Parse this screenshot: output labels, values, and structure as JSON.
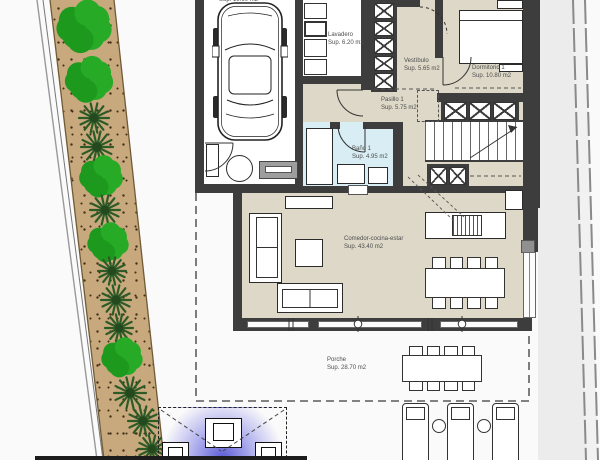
{
  "floorplan": {
    "garage": {
      "area": "Sup. 19.60 m2"
    },
    "lavadero": {
      "name": "Lavadero",
      "area": "Sup. 6.20 m2"
    },
    "vestibulo": {
      "name": "Vestíbulo",
      "area": "Sup. 5.65 m2"
    },
    "dormitorio1": {
      "name": "Dormitorio 1",
      "area": "Sup. 10.80 m2"
    },
    "pasillo1": {
      "name": "Pasillo 1",
      "area": "Sup. 5.75 m2"
    },
    "bano1": {
      "name": "Baño 1",
      "area": "Sup. 4.95 m2"
    },
    "comedor": {
      "name": "Comedor-cocina-estar",
      "area": "Sup. 43.40 m2"
    },
    "porche": {
      "name": "Porche",
      "area": "Sup. 28.70 m2"
    }
  },
  "garden": {
    "trees": [
      {
        "type": "tree",
        "x": 84,
        "y": 26,
        "r": 24
      },
      {
        "type": "tree",
        "x": 89,
        "y": 79,
        "r": 21
      },
      {
        "type": "palm",
        "x": 94,
        "y": 118,
        "r": 15
      },
      {
        "type": "palm",
        "x": 97,
        "y": 147,
        "r": 16
      },
      {
        "type": "tree",
        "x": 101,
        "y": 176,
        "r": 19
      },
      {
        "type": "palm",
        "x": 105,
        "y": 210,
        "r": 15
      },
      {
        "type": "tree",
        "x": 108,
        "y": 242,
        "r": 18
      },
      {
        "type": "palm",
        "x": 112,
        "y": 271,
        "r": 14
      },
      {
        "type": "palm",
        "x": 116,
        "y": 300,
        "r": 15
      },
      {
        "type": "palm",
        "x": 119,
        "y": 328,
        "r": 14
      },
      {
        "type": "tree",
        "x": 122,
        "y": 357,
        "r": 18
      },
      {
        "type": "palm",
        "x": 130,
        "y": 393,
        "r": 16
      },
      {
        "type": "palm",
        "x": 143,
        "y": 421,
        "r": 15
      },
      {
        "type": "palm",
        "x": 152,
        "y": 449,
        "r": 14
      }
    ]
  },
  "colors": {
    "wall": "#3d3d3d",
    "floor_interior": "#ddd8c7",
    "floor_bath": "#d8eef4",
    "garden_strip": "#c8a87d",
    "tree_green": "#27ab27",
    "palm_green": "#2d5b28",
    "pergola_glow": "#5656d6"
  }
}
